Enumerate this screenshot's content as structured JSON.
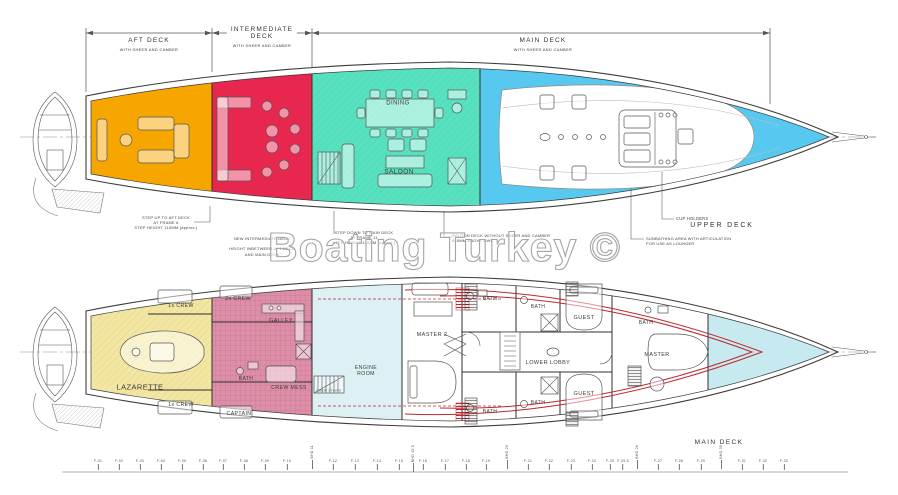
{
  "watermark": "Boating Turkey ©",
  "colors": {
    "aft_deck": "#F7A600",
    "intermediate": "#E8274E",
    "saloon": "#58E1BF",
    "upper_deck_blue": "#57C9F0",
    "crew_yellow": "#F2E6A2",
    "crew_pink": "#DD8FA7",
    "guest_cyan": "#DDF1F4",
    "bow_cyan": "#C6EAF0",
    "accent_red": "#C1272D"
  },
  "dimension_bar": {
    "aft": {
      "title": "AFT DECK",
      "sub": "WITH SHEER AND CAMBER"
    },
    "intermediate": {
      "title": "INTERMEDIATE\nDECK",
      "sub": "WITH SHEER AND CAMBER"
    },
    "main": {
      "title": "MAIN DECK",
      "sub": "WITH SHEER AND CAMBER"
    }
  },
  "upper_plan": {
    "deck_label": "UPPER DECK",
    "rooms": [
      {
        "name": "label-dining",
        "text": "DINING",
        "x": 398,
        "y": 104,
        "fs": 6
      },
      {
        "name": "label-saloon",
        "text": "SALOON",
        "x": 399,
        "y": 172,
        "fs": 6.5
      }
    ],
    "annotations": {
      "step_up": "STEP UP TO AFT DECK\nAT FRAME 6\nSTEP HEIGHT 110MM (approx.)",
      "new_intermediate": "NEW INTERMEDIATE DECK\n\nHEIGHT INBETWEEN AFT DECK\nAND MAIN DECK",
      "step_down": "STEP DOWN TO MAIN DECK\nAT FRAME 11\nSTEP HEIGHT 110MM (approx.)",
      "saloon_deck": "SALOON DECK WITHOUT SHEER AND CAMBER\n840MM ABOVE DWL",
      "cup_holders": "CUP HOLDERS",
      "sunbathing": "SUNBATHING AREA WITH ARTICULATION\nFOR USE AS LOUNGER"
    }
  },
  "lower_plan": {
    "deck_label": "MAIN DECK",
    "rooms": [
      {
        "name": "label-lazarette",
        "text": "LAZARETTE",
        "x": 140,
        "y": 388,
        "fs": 7.5
      },
      {
        "name": "label-crew-1x-top",
        "text": "1x CREW",
        "x": 181,
        "y": 307,
        "fs": 5.2
      },
      {
        "name": "label-crew-1x-bottom",
        "text": "1x CREW",
        "x": 181,
        "y": 406,
        "fs": 5.2
      },
      {
        "name": "label-crew-2x",
        "text": "2x CREW",
        "x": 238,
        "y": 300,
        "fs": 5.2
      },
      {
        "name": "label-galley",
        "text": "GALLEY",
        "x": 281,
        "y": 321,
        "fs": 5.5
      },
      {
        "name": "label-bath-crew",
        "text": "BATH",
        "x": 246,
        "y": 380,
        "fs": 5
      },
      {
        "name": "label-crew-mess",
        "text": "CREW MESS",
        "x": 289,
        "y": 389,
        "fs": 5.2
      },
      {
        "name": "label-captain",
        "text": "CAPTAIN",
        "x": 239,
        "y": 415,
        "fs": 5.2
      },
      {
        "name": "label-engine-room",
        "text": "ENGINE\nROOM",
        "x": 366,
        "y": 372,
        "fs": 5.2
      },
      {
        "name": "label-crew-stairs",
        "text": "CREW STAIRS",
        "x": 329,
        "y": 391,
        "fs": 3
      },
      {
        "name": "label-master-2",
        "text": "MASTER 2",
        "x": 432,
        "y": 335,
        "fs": 5.5
      },
      {
        "name": "label-bath-master2-top",
        "text": "BATH",
        "x": 490,
        "y": 300,
        "fs": 5
      },
      {
        "name": "label-bath-guest-top",
        "text": "BATH",
        "x": 538,
        "y": 308,
        "fs": 5
      },
      {
        "name": "label-guest-top",
        "text": "GUEST",
        "x": 584,
        "y": 318,
        "fs": 5.5
      },
      {
        "name": "label-bath-master",
        "text": "BATH",
        "x": 646,
        "y": 324,
        "fs": 5
      },
      {
        "name": "label-master",
        "text": "MASTER",
        "x": 657,
        "y": 355,
        "fs": 5.5
      },
      {
        "name": "label-lower-lobby",
        "text": "LOWER LOBBY",
        "x": 548,
        "y": 363,
        "fs": 5.5
      },
      {
        "name": "label-guest-bottom",
        "text": "GUEST",
        "x": 584,
        "y": 394,
        "fs": 5.5
      },
      {
        "name": "label-bath-guest-bottom",
        "text": "BATH",
        "x": 538,
        "y": 404,
        "fs": 5
      },
      {
        "name": "label-bath-master2-bottom",
        "text": "BATH",
        "x": 490,
        "y": 413,
        "fs": 5
      }
    ]
  },
  "ruler": {
    "frames": [
      {
        "label": "F-01",
        "x": 98
      },
      {
        "label": "F-02",
        "x": 119
      },
      {
        "label": "F-03",
        "x": 140
      },
      {
        "label": "F-04",
        "x": 161
      },
      {
        "label": "F-05",
        "x": 182
      },
      {
        "label": "F-06",
        "x": 203
      },
      {
        "label": "F-07",
        "x": 223
      },
      {
        "label": "F-08",
        "x": 244
      },
      {
        "label": "F-09",
        "x": 265
      },
      {
        "label": "F-10",
        "x": 287
      },
      {
        "label": "BHD 11",
        "x": 312,
        "vertical": true
      },
      {
        "label": "F-12",
        "x": 333
      },
      {
        "label": "F-13",
        "x": 355
      },
      {
        "label": "F-14",
        "x": 377
      },
      {
        "label": "F-15",
        "x": 399
      },
      {
        "label": "BHD 15.5",
        "x": 413,
        "vertical": true
      },
      {
        "label": "F-16",
        "x": 423
      },
      {
        "label": "F-17",
        "x": 445
      },
      {
        "label": "F-18",
        "x": 466
      },
      {
        "label": "F-19",
        "x": 486
      },
      {
        "label": "BHD 20",
        "x": 507,
        "vertical": true
      },
      {
        "label": "F-21",
        "x": 528
      },
      {
        "label": "F-22",
        "x": 549
      },
      {
        "label": "F-23",
        "x": 571
      },
      {
        "label": "F-24",
        "x": 592
      },
      {
        "label": "F-25",
        "x": 610
      },
      {
        "label": "F-25.5",
        "x": 623
      },
      {
        "label": "BHD 26",
        "x": 637,
        "vertical": true
      },
      {
        "label": "F-27",
        "x": 658
      },
      {
        "label": "F-28",
        "x": 679
      },
      {
        "label": "F-29",
        "x": 701
      },
      {
        "label": "BHD 30",
        "x": 721,
        "vertical": true
      },
      {
        "label": "F-31",
        "x": 742
      },
      {
        "label": "F-32",
        "x": 763
      },
      {
        "label": "F-33",
        "x": 784
      }
    ]
  }
}
